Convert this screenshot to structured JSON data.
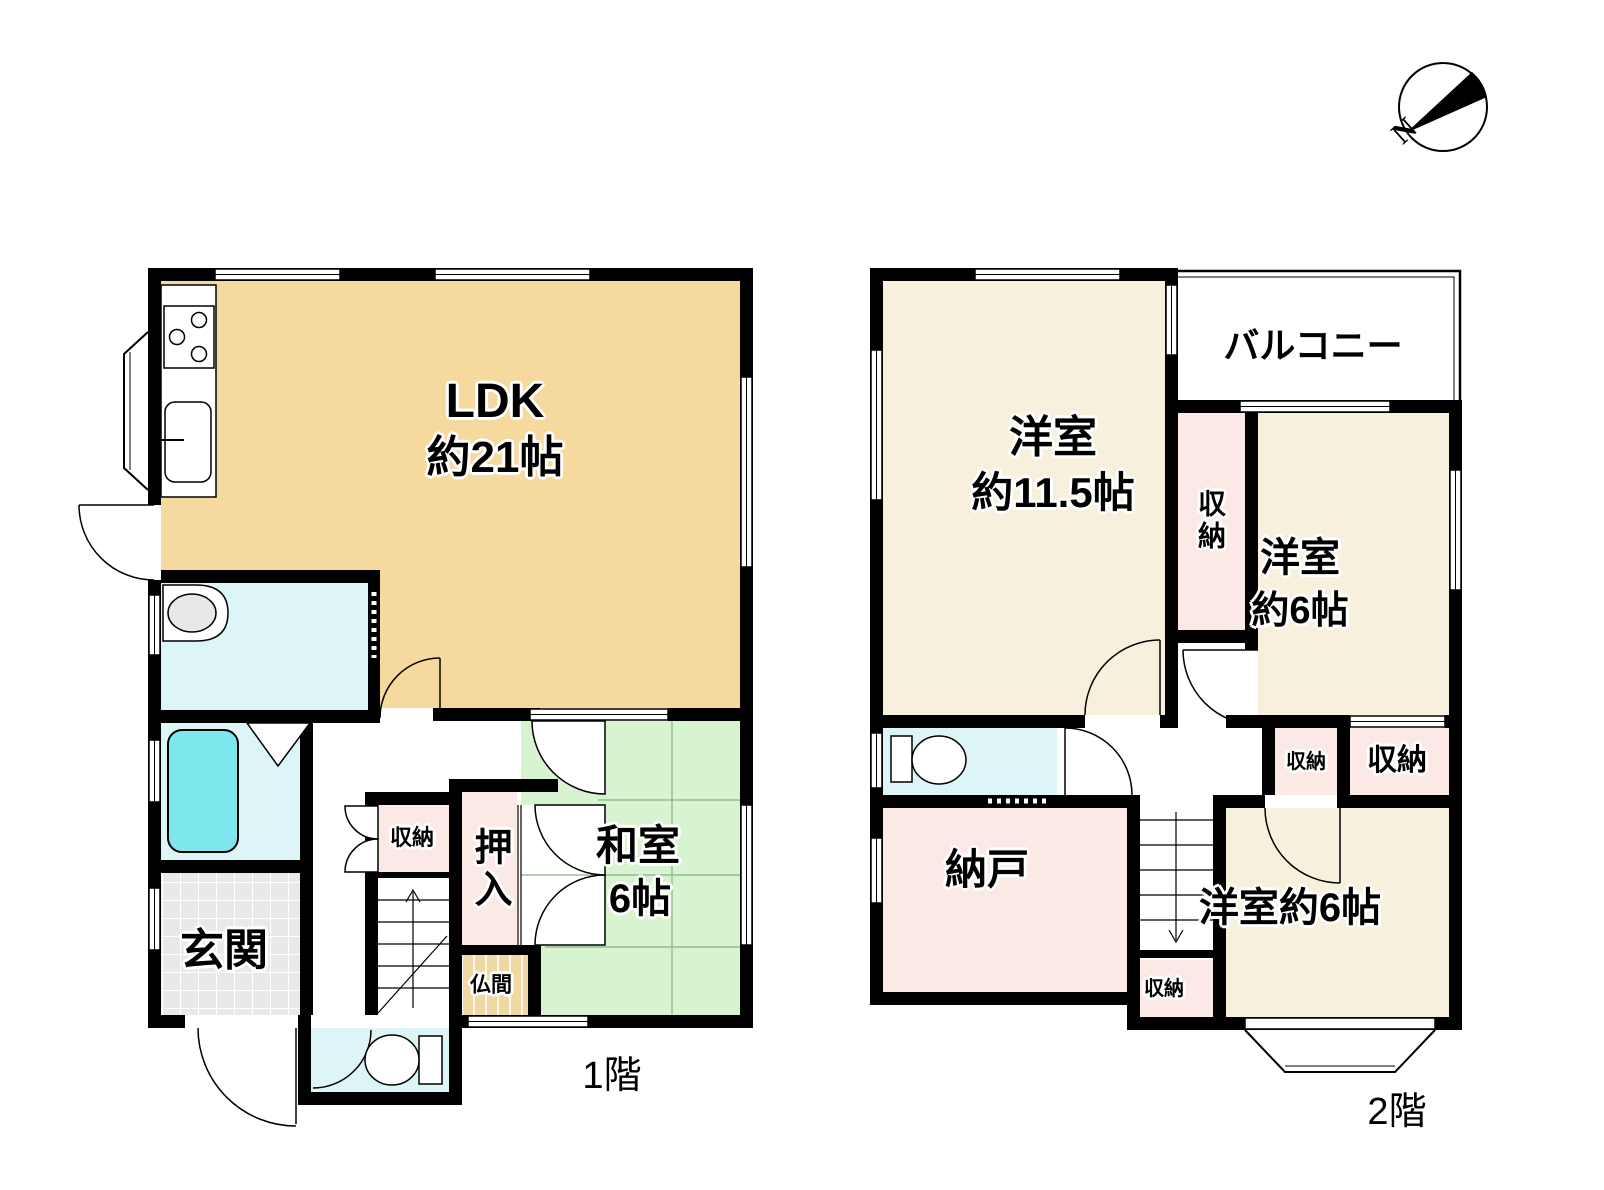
{
  "compass": {
    "north": "N"
  },
  "colors": {
    "wall": "#000000",
    "ldk": "#F5D99E",
    "tatami": "#D8F3CF",
    "western": "#F7F0DD",
    "closet": "#FBE9E5",
    "wet_area": "#DDF5F6",
    "bathtub": "#7EE7EE",
    "entrance_tile": "#E9E9E9",
    "altar_room": "#F0D8A2"
  },
  "floor1": {
    "label": "1階",
    "ldk": {
      "l1": "LDK",
      "l2": "約21帖"
    },
    "washitsu": {
      "l1": "和室",
      "l2": "6帖"
    },
    "genkan": "玄関",
    "closet": "収納",
    "oshiire": "押入",
    "butsuma": "仏間"
  },
  "floor2": {
    "label": "2階",
    "western115": {
      "l1": "洋室",
      "l2": "約11.5帖"
    },
    "balcony": "バルコニー",
    "closet_tall": "収納",
    "western6_top": {
      "l1": "洋室",
      "l2": "約6帖"
    },
    "closet_mid": "収納",
    "closet_right": "収納",
    "nando": "納戸",
    "western6_bottom": "洋室約6帖",
    "closet_stairs": "収納"
  }
}
